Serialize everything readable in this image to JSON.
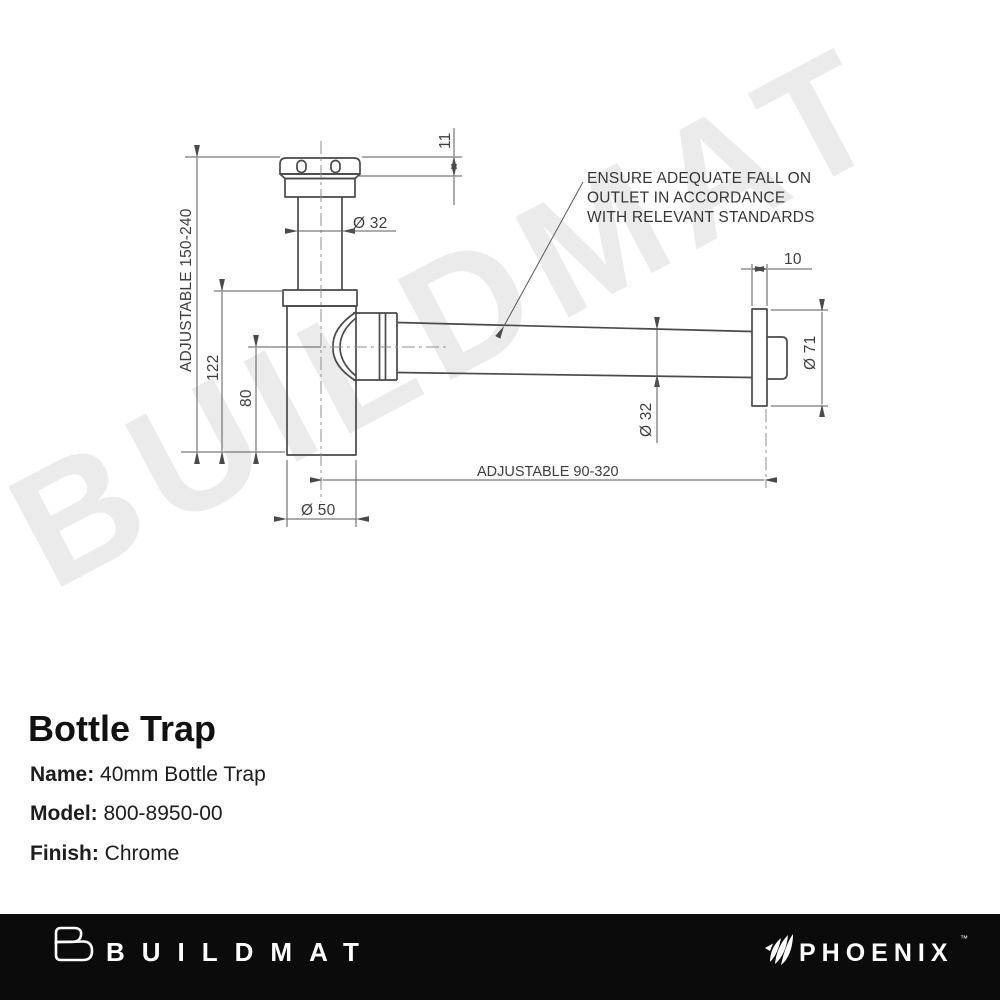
{
  "watermark": "BUILDMAT",
  "drawing": {
    "note": {
      "line1": "ENSURE ADEQUATE FALL ON",
      "line2": "OUTLET IN ACCORDANCE",
      "line3": "WITH RELEVANT STANDARDS"
    },
    "dims": {
      "adjustable_vertical": "ADJUSTABLE 150-240",
      "adjustable_horizontal": "ADJUSTABLE 90-320",
      "nut_height": "11",
      "inlet_diameter": "Ø 32",
      "body_height": "122",
      "outlet_center_height": "80",
      "body_diameter": "Ø 50",
      "pipe_diameter": "Ø 32",
      "flange_thickness": "10",
      "flange_diameter": "Ø 71"
    }
  },
  "product": {
    "title": "Bottle Trap",
    "name_label": "Name:",
    "name_value": "40mm Bottle Trap",
    "model_label": "Model:",
    "model_value": "800-8950-00",
    "finish_label": "Finish:",
    "finish_value": "Chrome"
  },
  "footer": {
    "buildmat_logo_text": "BUILDMAT",
    "phoenix_logo_text": "PHOENIX",
    "trademark": "™"
  },
  "colors": {
    "line": "#4a4a4a",
    "dimension": "#5a5a5a",
    "watermark": "#ebebeb",
    "footer_bg": "#0b0b0b",
    "footer_text": "#ffffff"
  }
}
